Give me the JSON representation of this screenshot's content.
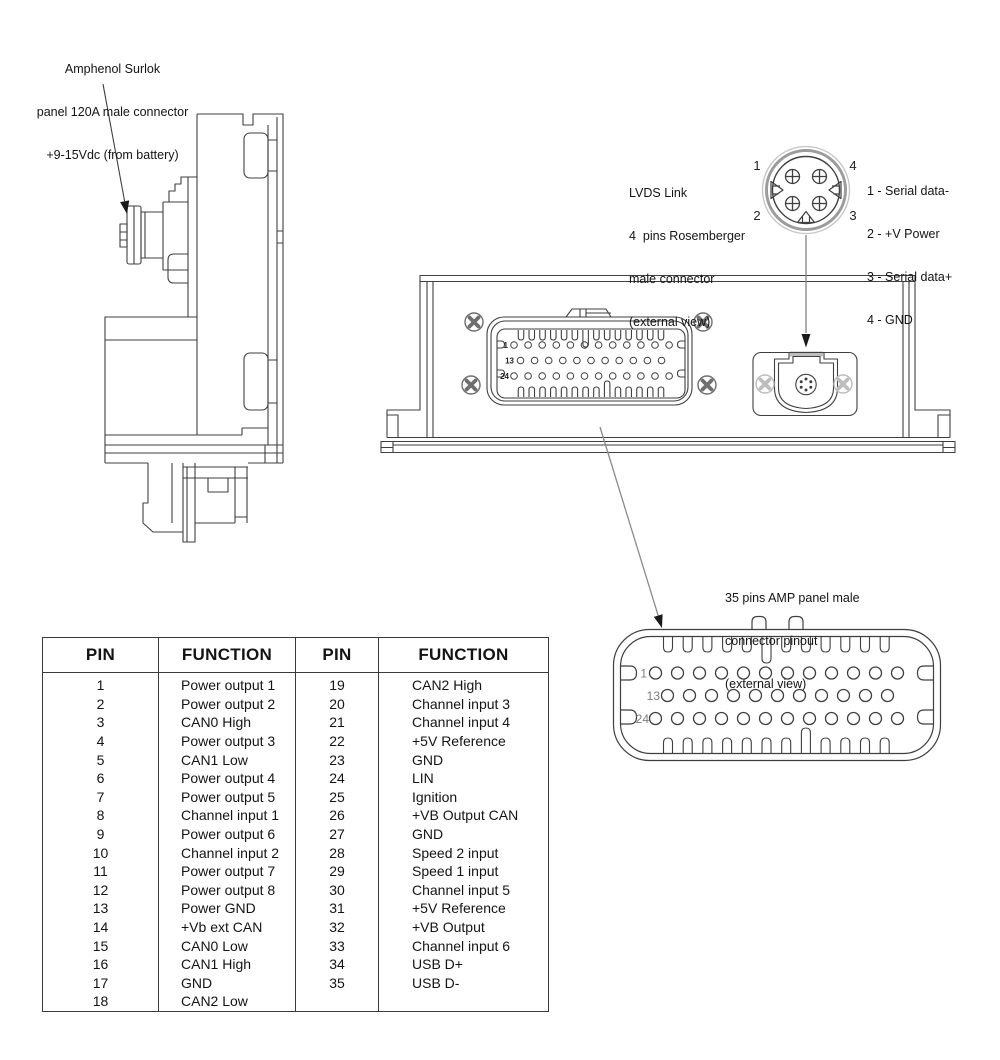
{
  "annotations": {
    "surlok_label": {
      "lines": [
        "Amphenol Surlok",
        "panel 120A male connector",
        "+9-15Vdc (from battery)"
      ]
    },
    "lvds_label": {
      "lines": [
        "LVDS Link",
        "4  pins Rosemberger",
        "male connector",
        "(external view)"
      ]
    },
    "lvds_pinout": {
      "lines": [
        "1 - Serial data-",
        "2 - +V Power",
        "3 - Serial data+",
        "4 - GND"
      ]
    },
    "amp_label": {
      "lines": [
        "35 pins AMP panel male",
        "connector pinout",
        "(external view)"
      ]
    }
  },
  "lvds_detail": {
    "pin_top_left": "1",
    "pin_top_right": "4",
    "pin_bottom_left": "2",
    "pin_bottom_right": "3"
  },
  "front_connector": {
    "row_labels": [
      "1",
      "13",
      "24"
    ],
    "row_pin_counts": [
      12,
      11,
      12
    ]
  },
  "amp_connector": {
    "row_labels": [
      "1",
      "13",
      "24"
    ],
    "row_pin_counts": [
      12,
      11,
      12
    ]
  },
  "pin_table": {
    "headers": [
      "PIN",
      "FUNCTION",
      "PIN",
      "FUNCTION"
    ],
    "rows": [
      [
        "1",
        "Power output 1",
        "19",
        "CAN2 High"
      ],
      [
        "2",
        "Power output 2",
        "20",
        "Channel input 3"
      ],
      [
        "3",
        "CAN0 High",
        "21",
        "Channel input 4"
      ],
      [
        "4",
        "Power output 3",
        "22",
        "+5V Reference"
      ],
      [
        "5",
        "CAN1 Low",
        "23",
        "GND"
      ],
      [
        "6",
        "Power output 4",
        "24",
        "LIN"
      ],
      [
        "7",
        "Power output 5",
        "25",
        "Ignition"
      ],
      [
        "8",
        "Channel input 1",
        "26",
        "+VB Output CAN"
      ],
      [
        "9",
        "Power output 6",
        "27",
        "GND"
      ],
      [
        "10",
        "Channel input 2",
        "28",
        "Speed 2 input"
      ],
      [
        "11",
        "Power output 7",
        "29",
        "Speed 1 input"
      ],
      [
        "12",
        "Power output 8",
        "30",
        "Channel input 5"
      ],
      [
        "13",
        "Power GND",
        "31",
        "+5V Reference"
      ],
      [
        "14",
        "+Vb ext CAN",
        "32",
        "+VB Output"
      ],
      [
        "15",
        "CAN0 Low",
        "33",
        "Channel input 6"
      ],
      [
        "16",
        "CAN1 High",
        "34",
        "USB D+"
      ],
      [
        "17",
        "GND",
        "35",
        "USB D-"
      ],
      [
        "18",
        "CAN2 Low",
        "",
        ""
      ]
    ]
  },
  "colors": {
    "line": "#3f3f3f",
    "gray_line": "#8a8a8a",
    "light_gray": "#bdbdbd",
    "label_gray": "#7e7e7e",
    "text": "#141414"
  }
}
